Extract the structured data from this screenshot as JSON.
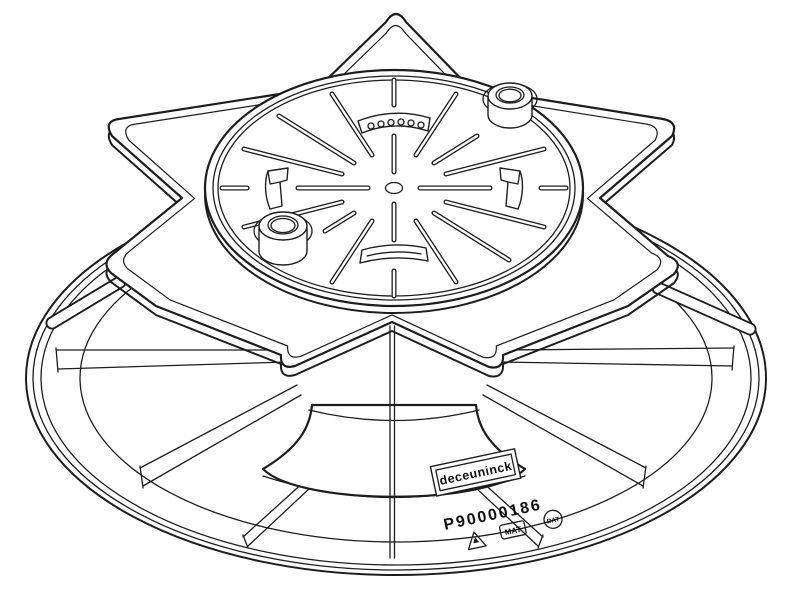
{
  "drawing": {
    "kind": "isometric technical line drawing",
    "subject": "adjustable terrace pedestal support with eight-point star plate, perforated rotating top disc and round base dish",
    "line_color": "#1d1d1d",
    "background_color": "#ffffff"
  },
  "label": {
    "brand": "deceuninck",
    "part_number": "P90000186",
    "stamp_mat": "MAT",
    "stamp_dat": "DAT",
    "stamp_triangle": "recycle-triangle"
  }
}
